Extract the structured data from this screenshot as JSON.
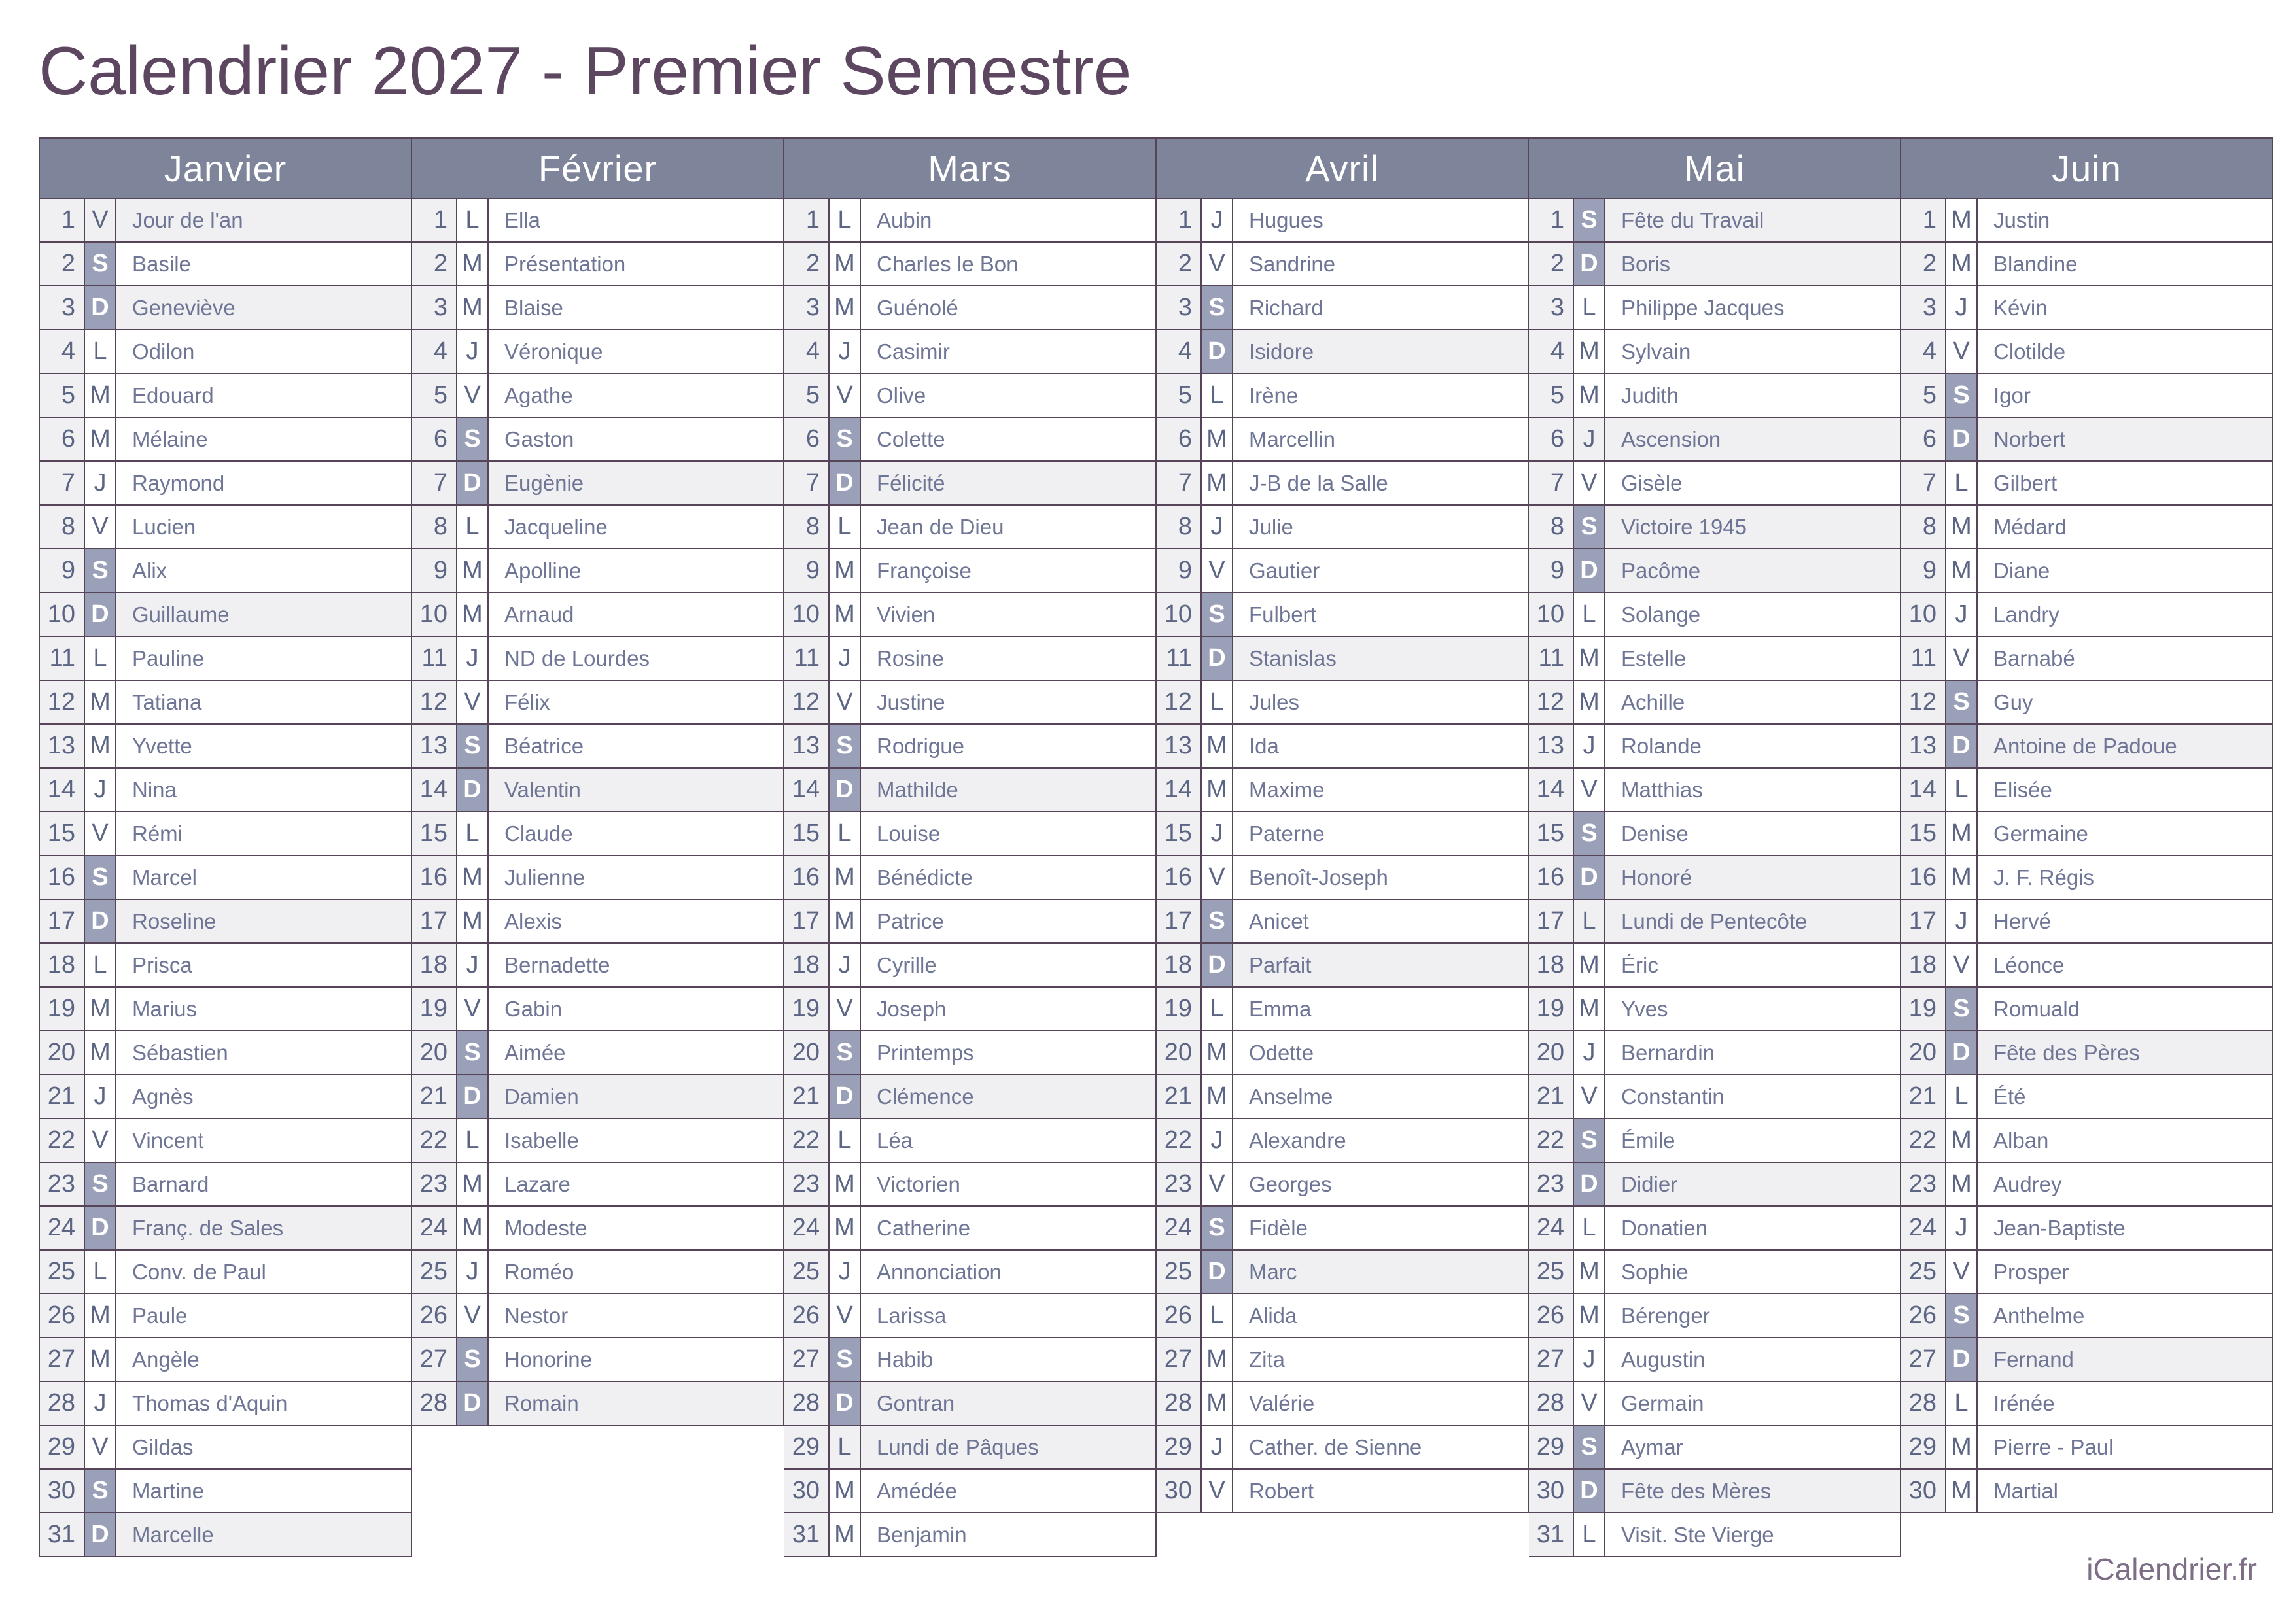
{
  "title": "Calendrier 2027 - Premier Semestre",
  "footer": "iCalendrier.fr",
  "colors": {
    "title_text": "#5d4660",
    "border": "#564458",
    "month_header_bg": "#7e8499",
    "month_header_text": "#ffffff",
    "weekend_badge_bg": "#9aa0b7",
    "weekend_badge_text": "#ffffff",
    "shaded_row_bg": "#f0f0f2",
    "day_number_text": "#5c6584",
    "saint_name_text": "#6f7695",
    "footer_text": "#7e6d86"
  },
  "legend": {
    "weekday_letters_meaning": "L=Lundi, M=Mardi/Mercredi, J=Jeudi, V=Vendredi, S=Samedi, D=Dimanche"
  },
  "months": [
    {
      "name": "Janvier",
      "days": [
        {
          "d": 1,
          "w": "V",
          "n": "Jour de l'an",
          "h": true
        },
        {
          "d": 2,
          "w": "S",
          "n": "Basile"
        },
        {
          "d": 3,
          "w": "D",
          "n": "Geneviève"
        },
        {
          "d": 4,
          "w": "L",
          "n": "Odilon"
        },
        {
          "d": 5,
          "w": "M",
          "n": "Edouard"
        },
        {
          "d": 6,
          "w": "M",
          "n": "Mélaine"
        },
        {
          "d": 7,
          "w": "J",
          "n": "Raymond"
        },
        {
          "d": 8,
          "w": "V",
          "n": "Lucien"
        },
        {
          "d": 9,
          "w": "S",
          "n": "Alix"
        },
        {
          "d": 10,
          "w": "D",
          "n": "Guillaume"
        },
        {
          "d": 11,
          "w": "L",
          "n": "Pauline"
        },
        {
          "d": 12,
          "w": "M",
          "n": "Tatiana"
        },
        {
          "d": 13,
          "w": "M",
          "n": "Yvette"
        },
        {
          "d": 14,
          "w": "J",
          "n": "Nina"
        },
        {
          "d": 15,
          "w": "V",
          "n": "Rémi"
        },
        {
          "d": 16,
          "w": "S",
          "n": "Marcel"
        },
        {
          "d": 17,
          "w": "D",
          "n": "Roseline"
        },
        {
          "d": 18,
          "w": "L",
          "n": "Prisca"
        },
        {
          "d": 19,
          "w": "M",
          "n": "Marius"
        },
        {
          "d": 20,
          "w": "M",
          "n": "Sébastien"
        },
        {
          "d": 21,
          "w": "J",
          "n": "Agnès"
        },
        {
          "d": 22,
          "w": "V",
          "n": "Vincent"
        },
        {
          "d": 23,
          "w": "S",
          "n": "Barnard"
        },
        {
          "d": 24,
          "w": "D",
          "n": "Franç. de Sales"
        },
        {
          "d": 25,
          "w": "L",
          "n": "Conv. de Paul"
        },
        {
          "d": 26,
          "w": "M",
          "n": "Paule"
        },
        {
          "d": 27,
          "w": "M",
          "n": "Angèle"
        },
        {
          "d": 28,
          "w": "J",
          "n": "Thomas d'Aquin"
        },
        {
          "d": 29,
          "w": "V",
          "n": "Gildas"
        },
        {
          "d": 30,
          "w": "S",
          "n": "Martine"
        },
        {
          "d": 31,
          "w": "D",
          "n": "Marcelle"
        }
      ]
    },
    {
      "name": "Février",
      "days": [
        {
          "d": 1,
          "w": "L",
          "n": "Ella"
        },
        {
          "d": 2,
          "w": "M",
          "n": "Présentation"
        },
        {
          "d": 3,
          "w": "M",
          "n": "Blaise"
        },
        {
          "d": 4,
          "w": "J",
          "n": "Véronique"
        },
        {
          "d": 5,
          "w": "V",
          "n": "Agathe"
        },
        {
          "d": 6,
          "w": "S",
          "n": "Gaston"
        },
        {
          "d": 7,
          "w": "D",
          "n": "Eugènie"
        },
        {
          "d": 8,
          "w": "L",
          "n": "Jacqueline"
        },
        {
          "d": 9,
          "w": "M",
          "n": "Apolline"
        },
        {
          "d": 10,
          "w": "M",
          "n": "Arnaud"
        },
        {
          "d": 11,
          "w": "J",
          "n": "ND de Lourdes"
        },
        {
          "d": 12,
          "w": "V",
          "n": "Félix"
        },
        {
          "d": 13,
          "w": "S",
          "n": "Béatrice"
        },
        {
          "d": 14,
          "w": "D",
          "n": "Valentin"
        },
        {
          "d": 15,
          "w": "L",
          "n": "Claude"
        },
        {
          "d": 16,
          "w": "M",
          "n": "Julienne"
        },
        {
          "d": 17,
          "w": "M",
          "n": "Alexis"
        },
        {
          "d": 18,
          "w": "J",
          "n": "Bernadette"
        },
        {
          "d": 19,
          "w": "V",
          "n": "Gabin"
        },
        {
          "d": 20,
          "w": "S",
          "n": "Aimée"
        },
        {
          "d": 21,
          "w": "D",
          "n": "Damien"
        },
        {
          "d": 22,
          "w": "L",
          "n": "Isabelle"
        },
        {
          "d": 23,
          "w": "M",
          "n": "Lazare"
        },
        {
          "d": 24,
          "w": "M",
          "n": "Modeste"
        },
        {
          "d": 25,
          "w": "J",
          "n": "Roméo"
        },
        {
          "d": 26,
          "w": "V",
          "n": "Nestor"
        },
        {
          "d": 27,
          "w": "S",
          "n": "Honorine"
        },
        {
          "d": 28,
          "w": "D",
          "n": "Romain"
        }
      ]
    },
    {
      "name": "Mars",
      "days": [
        {
          "d": 1,
          "w": "L",
          "n": "Aubin"
        },
        {
          "d": 2,
          "w": "M",
          "n": "Charles le Bon"
        },
        {
          "d": 3,
          "w": "M",
          "n": "Guénolé"
        },
        {
          "d": 4,
          "w": "J",
          "n": "Casimir"
        },
        {
          "d": 5,
          "w": "V",
          "n": "Olive"
        },
        {
          "d": 6,
          "w": "S",
          "n": "Colette"
        },
        {
          "d": 7,
          "w": "D",
          "n": "Félicité"
        },
        {
          "d": 8,
          "w": "L",
          "n": "Jean de Dieu"
        },
        {
          "d": 9,
          "w": "M",
          "n": "Françoise"
        },
        {
          "d": 10,
          "w": "M",
          "n": "Vivien"
        },
        {
          "d": 11,
          "w": "J",
          "n": "Rosine"
        },
        {
          "d": 12,
          "w": "V",
          "n": "Justine"
        },
        {
          "d": 13,
          "w": "S",
          "n": "Rodrigue"
        },
        {
          "d": 14,
          "w": "D",
          "n": "Mathilde"
        },
        {
          "d": 15,
          "w": "L",
          "n": "Louise"
        },
        {
          "d": 16,
          "w": "M",
          "n": "Bénédicte"
        },
        {
          "d": 17,
          "w": "M",
          "n": "Patrice"
        },
        {
          "d": 18,
          "w": "J",
          "n": "Cyrille"
        },
        {
          "d": 19,
          "w": "V",
          "n": "Joseph"
        },
        {
          "d": 20,
          "w": "S",
          "n": "Printemps"
        },
        {
          "d": 21,
          "w": "D",
          "n": "Clémence"
        },
        {
          "d": 22,
          "w": "L",
          "n": "Léa"
        },
        {
          "d": 23,
          "w": "M",
          "n": "Victorien"
        },
        {
          "d": 24,
          "w": "M",
          "n": "Catherine"
        },
        {
          "d": 25,
          "w": "J",
          "n": "Annonciation"
        },
        {
          "d": 26,
          "w": "V",
          "n": "Larissa"
        },
        {
          "d": 27,
          "w": "S",
          "n": "Habib"
        },
        {
          "d": 28,
          "w": "D",
          "n": "Gontran"
        },
        {
          "d": 29,
          "w": "L",
          "n": "Lundi de Pâques",
          "h": true
        },
        {
          "d": 30,
          "w": "M",
          "n": "Amédée"
        },
        {
          "d": 31,
          "w": "M",
          "n": "Benjamin"
        }
      ]
    },
    {
      "name": "Avril",
      "days": [
        {
          "d": 1,
          "w": "J",
          "n": "Hugues"
        },
        {
          "d": 2,
          "w": "V",
          "n": "Sandrine"
        },
        {
          "d": 3,
          "w": "S",
          "n": "Richard"
        },
        {
          "d": 4,
          "w": "D",
          "n": "Isidore"
        },
        {
          "d": 5,
          "w": "L",
          "n": "Irène"
        },
        {
          "d": 6,
          "w": "M",
          "n": "Marcellin"
        },
        {
          "d": 7,
          "w": "M",
          "n": "J-B de la Salle"
        },
        {
          "d": 8,
          "w": "J",
          "n": "Julie"
        },
        {
          "d": 9,
          "w": "V",
          "n": "Gautier"
        },
        {
          "d": 10,
          "w": "S",
          "n": "Fulbert"
        },
        {
          "d": 11,
          "w": "D",
          "n": "Stanislas"
        },
        {
          "d": 12,
          "w": "L",
          "n": "Jules"
        },
        {
          "d": 13,
          "w": "M",
          "n": "Ida"
        },
        {
          "d": 14,
          "w": "M",
          "n": "Maxime"
        },
        {
          "d": 15,
          "w": "J",
          "n": "Paterne"
        },
        {
          "d": 16,
          "w": "V",
          "n": "Benoît-Joseph"
        },
        {
          "d": 17,
          "w": "S",
          "n": "Anicet"
        },
        {
          "d": 18,
          "w": "D",
          "n": "Parfait"
        },
        {
          "d": 19,
          "w": "L",
          "n": "Emma"
        },
        {
          "d": 20,
          "w": "M",
          "n": "Odette"
        },
        {
          "d": 21,
          "w": "M",
          "n": "Anselme"
        },
        {
          "d": 22,
          "w": "J",
          "n": "Alexandre"
        },
        {
          "d": 23,
          "w": "V",
          "n": "Georges"
        },
        {
          "d": 24,
          "w": "S",
          "n": "Fidèle"
        },
        {
          "d": 25,
          "w": "D",
          "n": "Marc"
        },
        {
          "d": 26,
          "w": "L",
          "n": "Alida"
        },
        {
          "d": 27,
          "w": "M",
          "n": "Zita"
        },
        {
          "d": 28,
          "w": "M",
          "n": "Valérie"
        },
        {
          "d": 29,
          "w": "J",
          "n": "Cather. de Sienne"
        },
        {
          "d": 30,
          "w": "V",
          "n": "Robert"
        }
      ]
    },
    {
      "name": "Mai",
      "days": [
        {
          "d": 1,
          "w": "S",
          "n": "Fête du Travail",
          "h": true
        },
        {
          "d": 2,
          "w": "D",
          "n": "Boris"
        },
        {
          "d": 3,
          "w": "L",
          "n": "Philippe Jacques"
        },
        {
          "d": 4,
          "w": "M",
          "n": "Sylvain"
        },
        {
          "d": 5,
          "w": "M",
          "n": "Judith"
        },
        {
          "d": 6,
          "w": "J",
          "n": "Ascension",
          "h": true
        },
        {
          "d": 7,
          "w": "V",
          "n": "Gisèle"
        },
        {
          "d": 8,
          "w": "S",
          "n": "Victoire 1945",
          "h": true
        },
        {
          "d": 9,
          "w": "D",
          "n": "Pacôme"
        },
        {
          "d": 10,
          "w": "L",
          "n": "Solange"
        },
        {
          "d": 11,
          "w": "M",
          "n": "Estelle"
        },
        {
          "d": 12,
          "w": "M",
          "n": "Achille"
        },
        {
          "d": 13,
          "w": "J",
          "n": "Rolande"
        },
        {
          "d": 14,
          "w": "V",
          "n": "Matthias"
        },
        {
          "d": 15,
          "w": "S",
          "n": "Denise"
        },
        {
          "d": 16,
          "w": "D",
          "n": "Honoré"
        },
        {
          "d": 17,
          "w": "L",
          "n": "Lundi de Pentecôte",
          "h": true
        },
        {
          "d": 18,
          "w": "M",
          "n": "Éric"
        },
        {
          "d": 19,
          "w": "M",
          "n": "Yves"
        },
        {
          "d": 20,
          "w": "J",
          "n": "Bernardin"
        },
        {
          "d": 21,
          "w": "V",
          "n": "Constantin"
        },
        {
          "d": 22,
          "w": "S",
          "n": "Émile"
        },
        {
          "d": 23,
          "w": "D",
          "n": "Didier"
        },
        {
          "d": 24,
          "w": "L",
          "n": "Donatien"
        },
        {
          "d": 25,
          "w": "M",
          "n": "Sophie"
        },
        {
          "d": 26,
          "w": "M",
          "n": "Bérenger"
        },
        {
          "d": 27,
          "w": "J",
          "n": "Augustin"
        },
        {
          "d": 28,
          "w": "V",
          "n": "Germain"
        },
        {
          "d": 29,
          "w": "S",
          "n": "Aymar"
        },
        {
          "d": 30,
          "w": "D",
          "n": "Fête des Mères"
        },
        {
          "d": 31,
          "w": "L",
          "n": "Visit. Ste Vierge"
        }
      ]
    },
    {
      "name": "Juin",
      "days": [
        {
          "d": 1,
          "w": "M",
          "n": "Justin"
        },
        {
          "d": 2,
          "w": "M",
          "n": "Blandine"
        },
        {
          "d": 3,
          "w": "J",
          "n": "Kévin"
        },
        {
          "d": 4,
          "w": "V",
          "n": "Clotilde"
        },
        {
          "d": 5,
          "w": "S",
          "n": "Igor"
        },
        {
          "d": 6,
          "w": "D",
          "n": "Norbert"
        },
        {
          "d": 7,
          "w": "L",
          "n": "Gilbert"
        },
        {
          "d": 8,
          "w": "M",
          "n": "Médard"
        },
        {
          "d": 9,
          "w": "M",
          "n": "Diane"
        },
        {
          "d": 10,
          "w": "J",
          "n": "Landry"
        },
        {
          "d": 11,
          "w": "V",
          "n": "Barnabé"
        },
        {
          "d": 12,
          "w": "S",
          "n": "Guy"
        },
        {
          "d": 13,
          "w": "D",
          "n": "Antoine de Padoue"
        },
        {
          "d": 14,
          "w": "L",
          "n": "Elisée"
        },
        {
          "d": 15,
          "w": "M",
          "n": "Germaine"
        },
        {
          "d": 16,
          "w": "M",
          "n": "J. F. Régis"
        },
        {
          "d": 17,
          "w": "J",
          "n": "Hervé"
        },
        {
          "d": 18,
          "w": "V",
          "n": "Léonce"
        },
        {
          "d": 19,
          "w": "S",
          "n": "Romuald"
        },
        {
          "d": 20,
          "w": "D",
          "n": "Fête des Pères"
        },
        {
          "d": 21,
          "w": "L",
          "n": "Été"
        },
        {
          "d": 22,
          "w": "M",
          "n": "Alban"
        },
        {
          "d": 23,
          "w": "M",
          "n": "Audrey"
        },
        {
          "d": 24,
          "w": "J",
          "n": "Jean-Baptiste"
        },
        {
          "d": 25,
          "w": "V",
          "n": "Prosper"
        },
        {
          "d": 26,
          "w": "S",
          "n": "Anthelme"
        },
        {
          "d": 27,
          "w": "D",
          "n": "Fernand"
        },
        {
          "d": 28,
          "w": "L",
          "n": "Irénée"
        },
        {
          "d": 29,
          "w": "M",
          "n": "Pierre - Paul"
        },
        {
          "d": 30,
          "w": "M",
          "n": "Martial"
        }
      ]
    }
  ]
}
